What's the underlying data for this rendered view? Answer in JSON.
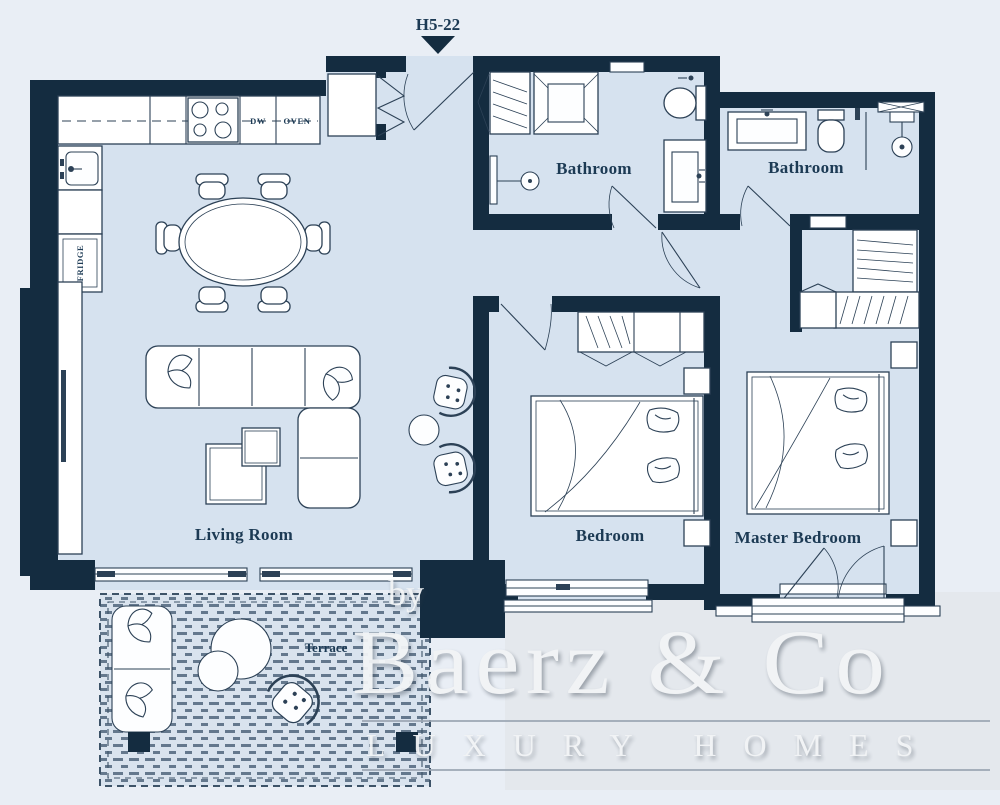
{
  "plan": {
    "unit_label": "H5-22",
    "rooms": {
      "living_room": "Living Room",
      "bedroom": "Bedroom",
      "master_bedroom": "Master Bedroom",
      "bathroom_1": "Bathroom",
      "bathroom_2": "Bathroom",
      "terrace": "Terrace"
    },
    "kitchen": {
      "dw": "DW",
      "oven": "OVEN",
      "fridge": "FRIDGE"
    }
  },
  "watermark": {
    "by": "by",
    "brand": "Baerz & Co",
    "tagline": "LUXURY HOMES"
  },
  "colors": {
    "background": "#e9eef5",
    "floor": "#d6e2ef",
    "wall": "#142c40",
    "line": "#2c4156",
    "label": "#1c3a54",
    "watermark": "#f2f4f6",
    "panel": "#e4e8ed"
  }
}
